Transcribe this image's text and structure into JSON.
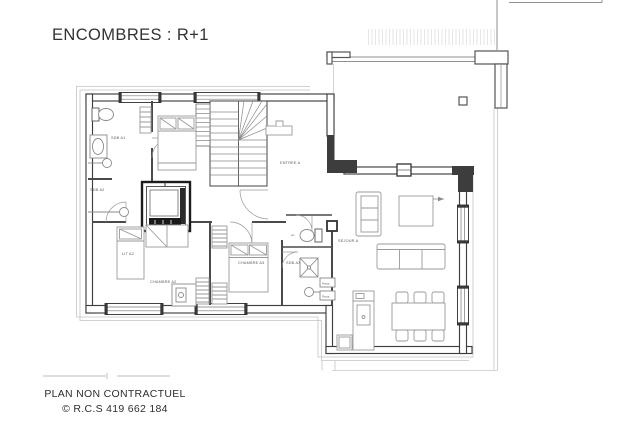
{
  "title": "ENCOMBRES : R+1",
  "footer": {
    "line1": "PLAN NON CONTRACTUEL",
    "line2": "© R.C.S 419 662 184"
  },
  "plan": {
    "labels": [
      {
        "id": "sdb-a1",
        "text": "SDB A1"
      },
      {
        "id": "sdb-a2",
        "text": "SDB A2"
      },
      {
        "id": "entree-a",
        "text": "ENTREE A"
      },
      {
        "id": "lit-a2",
        "text": "LIT A2"
      },
      {
        "id": "chambre-a2",
        "text": "CHAMBRE A2"
      },
      {
        "id": "chambre-a3",
        "text": "CHAMBRE A3"
      },
      {
        "id": "sdb-a3",
        "text": "SDB A3"
      },
      {
        "id": "wc",
        "text": "wc"
      },
      {
        "id": "sejour-a",
        "text": "SEJOUR A"
      },
      {
        "id": "rangt-1",
        "text": "Rangt"
      },
      {
        "id": "rangt-2",
        "text": "Rangt"
      }
    ],
    "colors": {
      "wall": "#3e3e3e",
      "thin_line": "#c4c4c4",
      "furniture": "#9a9a9a",
      "label_text": "#5a5a5a",
      "dark_fill": "#1a1a1a",
      "background": "#ffffff"
    }
  }
}
